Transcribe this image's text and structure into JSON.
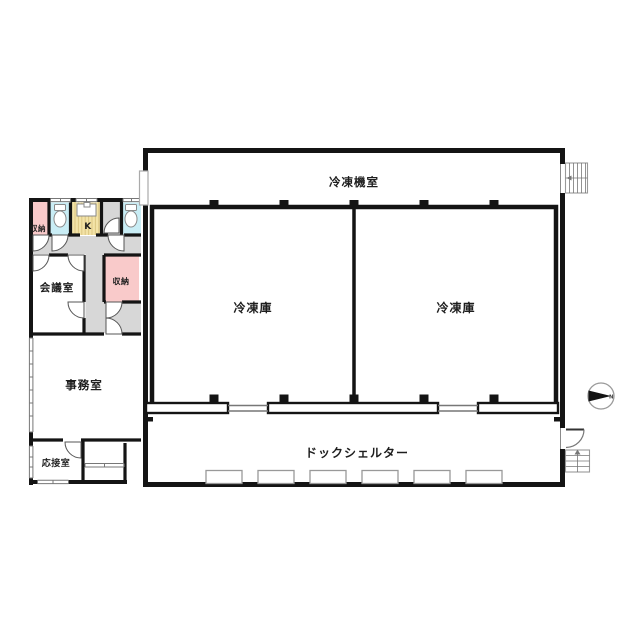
{
  "rooms": {
    "machine_room": "冷凍機室",
    "freezer_left": "冷凍庫",
    "freezer_right": "冷凍庫",
    "dock_shelter": "ドックシェルター",
    "office": "事務室",
    "meeting_room": "会議室",
    "reception_room": "応接室",
    "storage_top": "収納",
    "storage_mid": "収納",
    "kitchen": "K"
  },
  "compass": {
    "letter": "N"
  },
  "colors": {
    "wall": "#141414",
    "hallway_fill": "#d7d7d7",
    "storage_fill": "#f9caca",
    "toilet_fill": "#c9edf5",
    "kitchen_fill": "#f3e3a7",
    "background": "#ffffff"
  }
}
